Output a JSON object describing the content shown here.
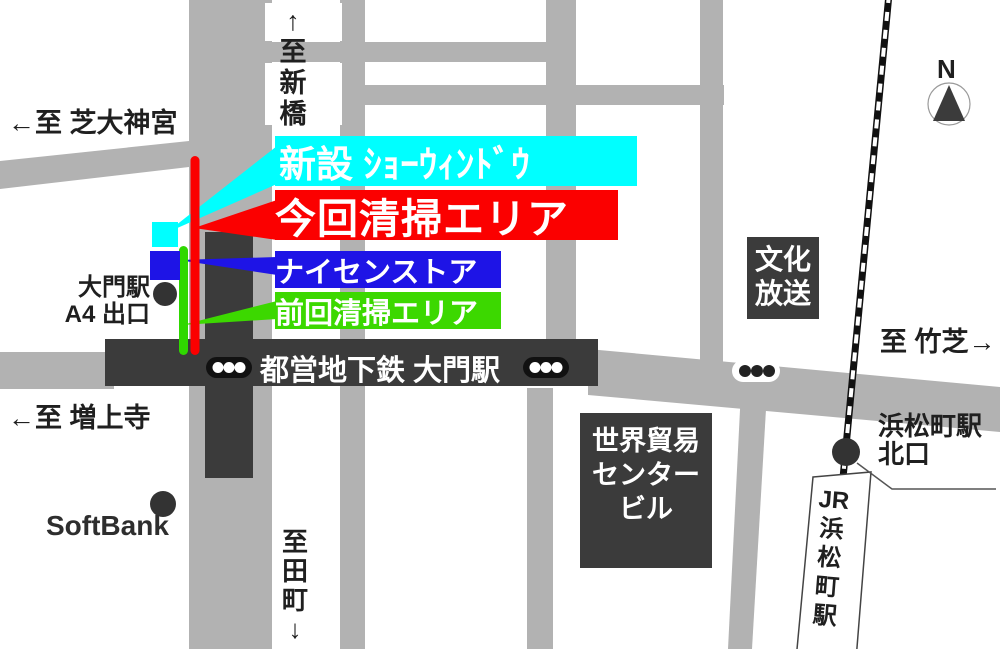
{
  "directions": {
    "shimbashi_chars": [
      "↑",
      "至",
      "新",
      "橋"
    ],
    "shiba_daijingu": "←至 芝大神宮",
    "zojoji": "←至 増上寺",
    "tamachi_chars": [
      "至",
      "田",
      "町",
      "↓"
    ],
    "takeshiba": "至 竹芝→"
  },
  "legend": {
    "new_show_window": {
      "label": "新設 ｼｮｰｳｨﾝﾄﾞｳ",
      "color": "#00ffff"
    },
    "current_cleaning_area": {
      "label": "今回清掃エリア",
      "color": "#fb0000"
    },
    "nicen_store": {
      "label": "ナイセンストア",
      "color": "#1e14e6"
    },
    "previous_cleaning_area": {
      "label": "前回清掃エリア",
      "color": "#3cd800"
    }
  },
  "stations": {
    "daimon_exit_line1": "大門駅",
    "daimon_exit_line2": "A4 出口",
    "toei_subway_daimon": "都営地下鉄 大門駅",
    "hamamatsucho_north_line1": "浜松町駅",
    "hamamatsucho_north_line2": "北口",
    "jr_hamamatsucho_chars": [
      "JR",
      "浜",
      "松",
      "町",
      "駅"
    ]
  },
  "buildings": {
    "bunka_hoso_lines": [
      "文化",
      "放送"
    ],
    "world_trade_center_lines": [
      "世界貿易",
      "センター",
      "ビル"
    ],
    "softbank": "SoftBank"
  },
  "compass": {
    "north_label": "N"
  },
  "colors": {
    "street_gray": "#b2b2b2",
    "dark_structure": "#3b3b3b",
    "highlight_cyan": "#00ffff",
    "highlight_red": "#fb0000",
    "highlight_blue": "#1e14e6",
    "highlight_green": "#3cd800"
  }
}
